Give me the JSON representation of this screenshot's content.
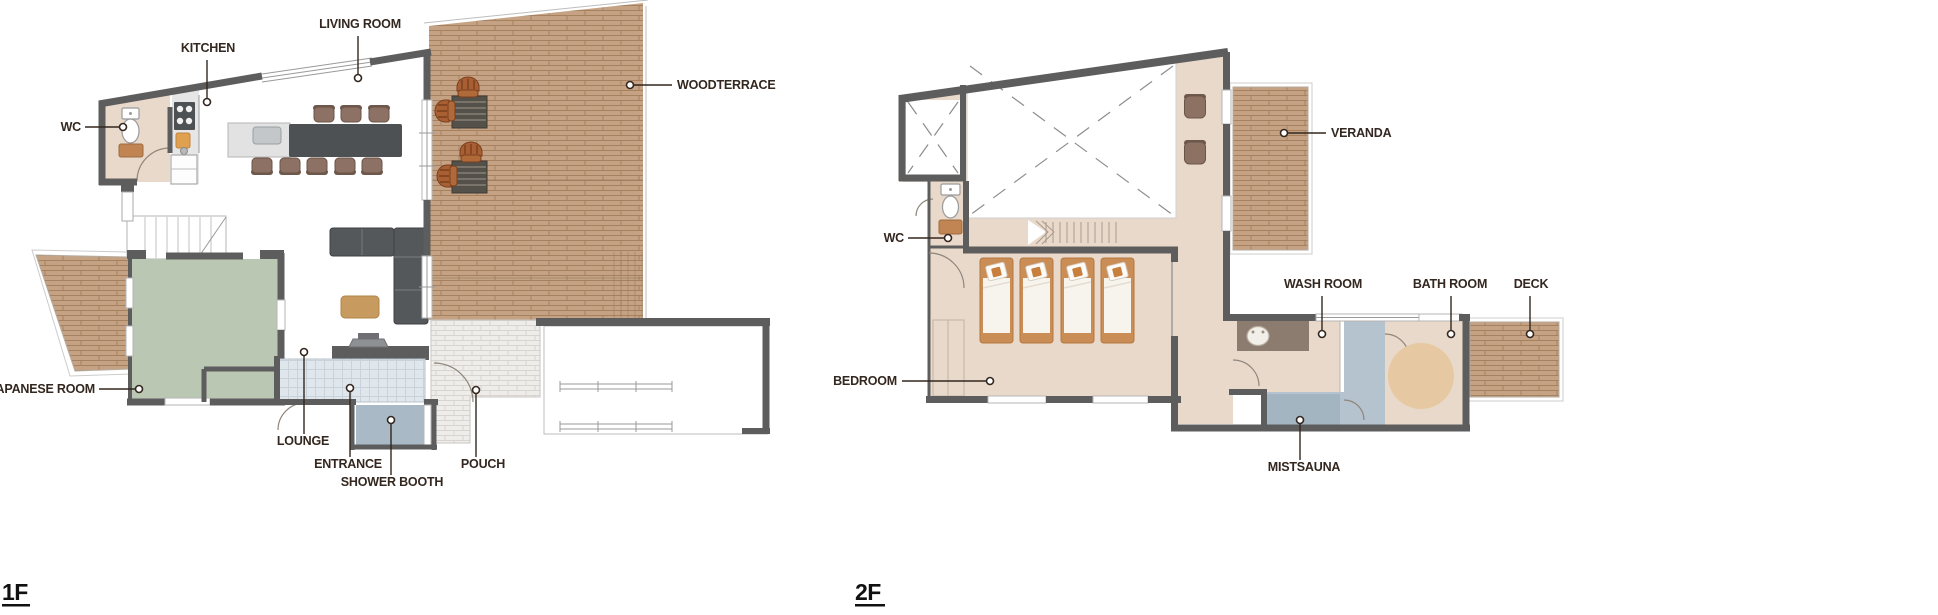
{
  "document": {
    "type": "floor-plan",
    "sheet_background": "#ffffff"
  },
  "floor1": {
    "title": "1F",
    "labels": {
      "kitchen": "KITCHEN",
      "living_room": "LIVING ROOM",
      "wc": "WC",
      "woodterrace": "WOODTERRACE",
      "japanese_room": "JAPANESE ROOM",
      "lounge": "LOUNGE",
      "entrance": "ENTRANCE",
      "shower_booth": "SHOWER BOOTH",
      "pouch": "POUCH"
    }
  },
  "floor2": {
    "title": "2F",
    "labels": {
      "veranda": "VERANDA",
      "wc": "WC",
      "bedroom": "BEDROOM",
      "wash_room": "WASH ROOM",
      "bath_room": "BATH ROOM",
      "deck": "DECK",
      "mistsauna": "MISTSAUNA"
    }
  },
  "colors": {
    "wall": "#5d5d5d",
    "label_text": "#33271f",
    "wood_deck": "#c5a284",
    "tatami": "#bac7b3",
    "entrance_tile": "#dfe6ec",
    "shower_booth": "#a9bac6",
    "pouch_brick": "#efedea",
    "floor_beige": "#e9d9cb",
    "sauna_blue": "#a2b5c1",
    "counter_brown": "#8c7c6f",
    "furniture_dark": "#4e5154",
    "chair_brown": "#8d7164",
    "bed_frame": "#c98d55"
  }
}
